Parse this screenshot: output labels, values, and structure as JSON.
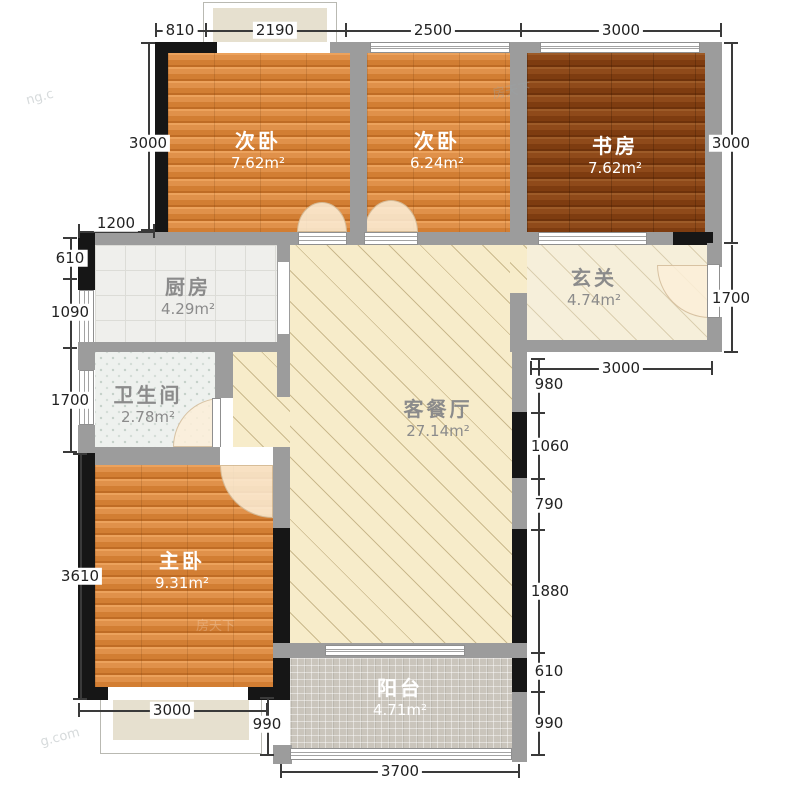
{
  "plan_title": "三室两厅户型图",
  "rooms": [
    {
      "label": "次卧",
      "area": "7.62m²"
    },
    {
      "label": "次卧",
      "area": "6.24m²"
    },
    {
      "label": "书房",
      "area": "7.62m²"
    },
    {
      "label": "厨房",
      "area": "4.29m²"
    },
    {
      "label": "玄关",
      "area": "4.74m²"
    },
    {
      "label": "卫生间",
      "area": "2.78m²"
    },
    {
      "label": "客餐厅",
      "area": "27.14m²"
    },
    {
      "label": "主卧",
      "area": "9.31m²"
    },
    {
      "label": "阳台",
      "area": "4.71m²"
    }
  ],
  "dims": {
    "top": [
      "810",
      "2190",
      "2500",
      "3000"
    ],
    "left": [
      "3000",
      "1200",
      "610",
      "1090",
      "1700",
      "3610"
    ],
    "right": [
      "3000",
      "1700"
    ],
    "right_chain": [
      "980",
      "1060",
      "790",
      "1880",
      "610",
      "990"
    ],
    "entry_bottom": "3000",
    "master_bottom": "3000",
    "bay_depth": "990",
    "bottom": "3700"
  },
  "watermarks": [
    "ng.c",
    "房天下",
    "g.com",
    "房天下"
  ],
  "colors": {
    "wood": "#db873c",
    "wood_dark": "#8a4517",
    "cream_floor": "#f7ecca",
    "entry_floor": "#f6efda",
    "kitchen_tile": "#efefec",
    "bath_tile": "#eef1ee",
    "balcony_tile": "#cac5bc",
    "wall_gray": "#9c9c9c",
    "wall_black": "#161616",
    "dim_text": "#222222"
  }
}
